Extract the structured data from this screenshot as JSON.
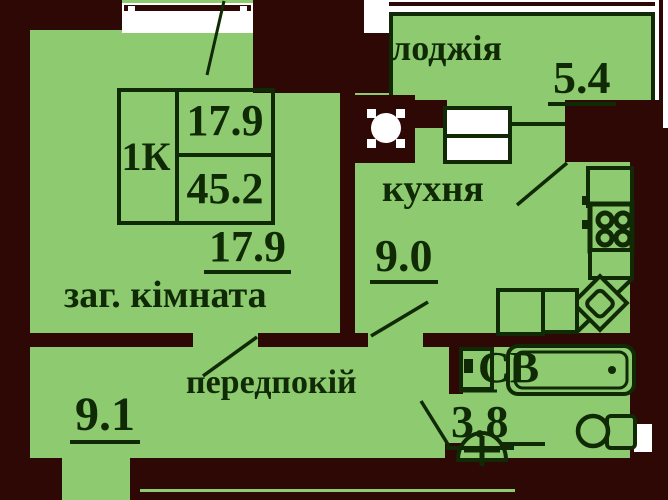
{
  "title_block": {
    "type": "1К",
    "living_area": "17.9",
    "total_area": "45.2"
  },
  "rooms": {
    "loggia": {
      "name": "лоджія",
      "area": "5.4"
    },
    "kitchen": {
      "name": "кухня",
      "area": "9.0"
    },
    "living_room": {
      "name": "заг. кімната",
      "area": "17.9"
    },
    "hallway": {
      "name": "передпокій",
      "area": "9.1"
    },
    "bathroom": {
      "name": "СВ",
      "area": "3.8"
    }
  },
  "fixtures": [
    "ventilation-shaft",
    "stove",
    "kitchen-sink",
    "cabinet",
    "washing-machine",
    "bathtub",
    "washbasin",
    "toilet"
  ],
  "colors": {
    "floor_green": "#8dca70",
    "wall_dark": "#2d0804",
    "line_dark": "#102a05",
    "wall_edge": "#4e1e26",
    "white": "#ffffff"
  }
}
